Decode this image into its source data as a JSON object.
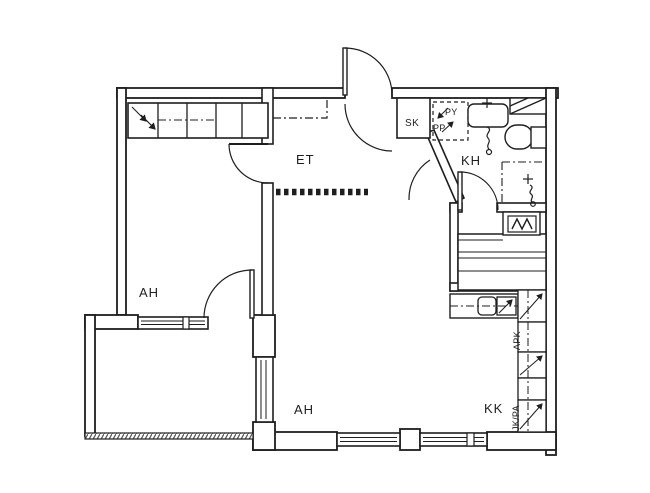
{
  "labels": {
    "et": "ET",
    "kh": "KH",
    "ah_left": "AH",
    "ah_main": "AH",
    "kk": "KK",
    "sk": "SK",
    "py": "PY",
    "pp": "PP",
    "apk": "APK",
    "jk_pa": "JK/PA"
  },
  "colors": {
    "line": "#1e1e1e",
    "background": "#ffffff",
    "railing_hatch": "#555555"
  }
}
